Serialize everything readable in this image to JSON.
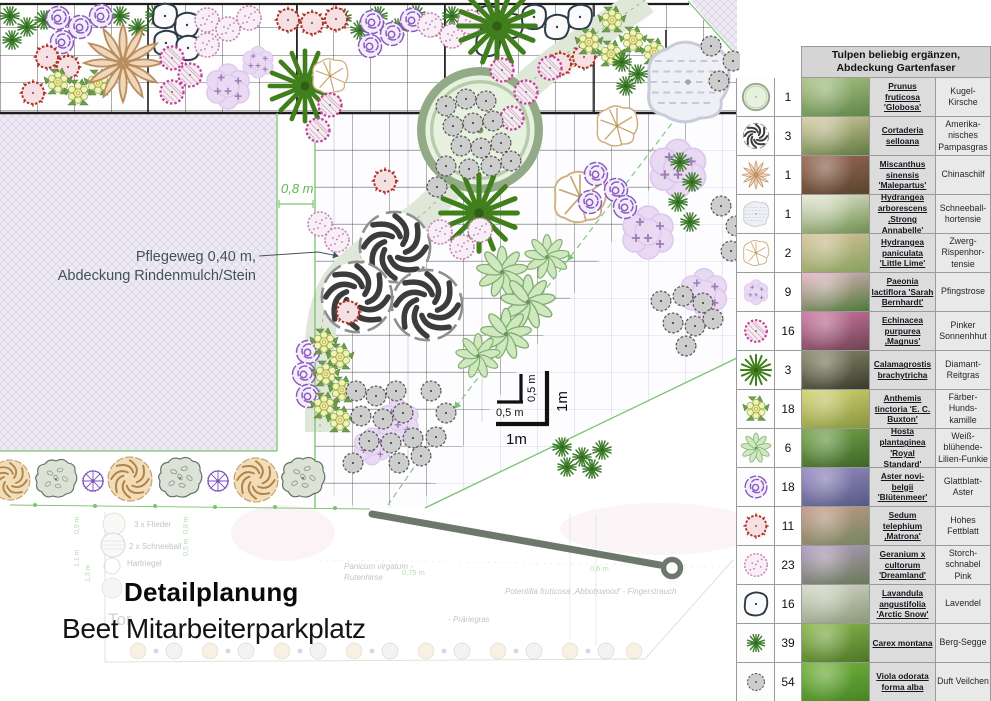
{
  "plan": {
    "annotation": {
      "line1": "Pflegeweg 0,40 m,",
      "line2": "Abdeckung Rindenmulch/Stein"
    },
    "dimension_strip": "0,8 m",
    "scale": {
      "small_h": "0,5 m",
      "small_v": "0,5 m",
      "large_h": "1m",
      "large_v": "1m"
    },
    "title": {
      "line1": "Detailplanung",
      "line2": "Beet Mitarbeiterparkplatz"
    },
    "overview": {
      "flieder": "3 x Flieder",
      "schneeball": "2 x Schneeball",
      "hartriegel": "Hartriegel",
      "tor": "Tor",
      "panicum_line1": "Panicum virgatum -",
      "panicum_line2": "Rutenhirse",
      "potentilla": "Potentilla fruticosa ,Abbotswood' - Fingerstrauch",
      "praeriegras": "- Präriegras",
      "dim_075": "0,75 m",
      "dim_06": "0,6 m",
      "dim_09": "0,9 m",
      "dim_08": "0,8 m",
      "dim_05": "0,5 m",
      "dim_11": "1,1 m",
      "dim_13": "1,3 m"
    },
    "colors": {
      "boundary_green": "#7cc371",
      "dimension_green": "#5fb553",
      "annotation_text": "#41535d",
      "leader_gray": "#6d786d"
    }
  },
  "table": {
    "header_line1": "Tulpen beliebig ergänzen,",
    "header_line2": "Abdeckung Gartenfaser",
    "rows": [
      {
        "symbol": "prunus",
        "qty": "1",
        "latin": "Prunus fruticosa 'Globosa'",
        "german": "Kugel-Kirsche",
        "photo": [
          "#aec487",
          "#5e8748"
        ]
      },
      {
        "symbol": "cortaderia",
        "qty": "3",
        "latin": "Cortaderia selloana",
        "german": "Amerika-nisches Pampasgras",
        "photo": [
          "#d9cfa5",
          "#60793f"
        ]
      },
      {
        "symbol": "miscanthus",
        "qty": "1",
        "latin": "Miscanthus sinensis 'Malepartus'",
        "german": "Chinaschilf",
        "photo": [
          "#9c6a55",
          "#59432f"
        ]
      },
      {
        "symbol": "hydrangea_arb",
        "qty": "1",
        "latin": "Hydrangea arborescens ,Strong Annabelle'",
        "german": "Schneeball-hortensie",
        "photo": [
          "#e9ead8",
          "#6f8f4e"
        ]
      },
      {
        "symbol": "hydrangea_pan",
        "qty": "2",
        "latin": "Hydrangea paniculata 'Little Lime'",
        "german": "Zwerg-Rispenhor-tensie",
        "photo": [
          "#d9c49b",
          "#87a15e"
        ]
      },
      {
        "symbol": "paeonia",
        "qty": "9",
        "latin": "Paeonia lactiflora 'Sarah Bernhardt'",
        "german": "Pfingstrose",
        "photo": [
          "#eab6c8",
          "#4c7a38"
        ]
      },
      {
        "symbol": "echinacea",
        "qty": "16",
        "latin": "Echinacea purpurea ,Magnus'",
        "german": "Pinker Sonnenhhut",
        "photo": [
          "#d178a4",
          "#6e4252"
        ]
      },
      {
        "symbol": "calamagrostis",
        "qty": "3",
        "latin": "Calamagrostis brachytricha",
        "german": "Diamant-Reitgras",
        "photo": [
          "#8d8c6e",
          "#393a2c"
        ]
      },
      {
        "symbol": "anthemis",
        "qty": "18",
        "latin": "Anthemis tinctoria 'E. C. Buxton'",
        "german": "Färber-Hunds-kamille",
        "photo": [
          "#d6d472",
          "#87953f"
        ]
      },
      {
        "symbol": "hosta",
        "qty": "6",
        "latin": "Hosta plantaginea 'Royal Standard'",
        "german": "Weiß-blühende-Lilien-Funkie",
        "photo": [
          "#79a74e",
          "#3c6527"
        ]
      },
      {
        "symbol": "aster",
        "qty": "18",
        "latin": "Aster novi-belgii 'Blütenmeer'",
        "german": "Glattblatt-Aster",
        "photo": [
          "#9a8cc4",
          "#555a83"
        ]
      },
      {
        "symbol": "sedum",
        "qty": "11",
        "latin": "Sedum telephium ,Matrona'",
        "german": "Hohes Fettblatt",
        "photo": [
          "#c79a87",
          "#73855f"
        ]
      },
      {
        "symbol": "geranium",
        "qty": "23",
        "latin": "Geranium x cultorum 'Dreamland'",
        "german": "Storch-schnabel Pink",
        "photo": [
          "#b49cc6",
          "#687a54"
        ]
      },
      {
        "symbol": "lavandula",
        "qty": "16",
        "latin": "Lavandula angustifolia 'Arctic Snow'",
        "german": "Lavendel",
        "photo": [
          "#d8d9cd",
          "#8a9a78"
        ]
      },
      {
        "symbol": "carex",
        "qty": "39",
        "latin": "Carex montana",
        "german": "Berg-Segge",
        "photo": [
          "#8cb94e",
          "#4c7627"
        ]
      },
      {
        "symbol": "viola",
        "qty": "54",
        "latin": "Viola odorata forma alba",
        "german": "Duft Veilchen",
        "photo": [
          "#76b53c",
          "#478526"
        ]
      }
    ]
  }
}
